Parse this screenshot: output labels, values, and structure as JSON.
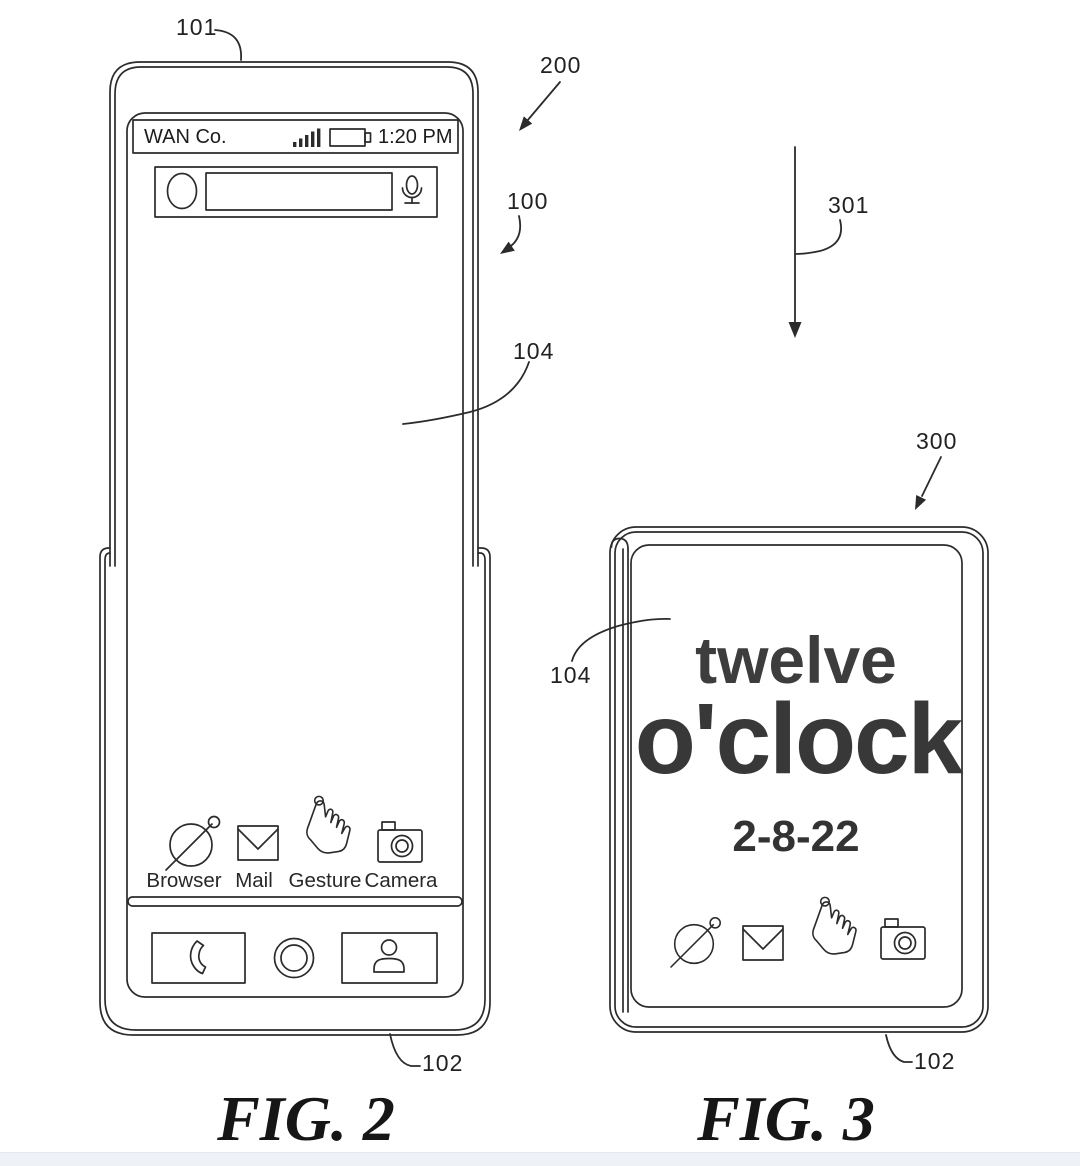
{
  "page": {
    "background": "#ffffff",
    "line_color": "#2b2b2b",
    "footer_strip_color": "#eef1f5"
  },
  "fig2": {
    "caption": "FIG. 2",
    "labels": {
      "l101": "101",
      "l200": "200",
      "l100": "100",
      "l104": "104",
      "l102": "102"
    },
    "status_bar": {
      "carrier": "WAN Co.",
      "time": "1:20 PM",
      "icons": [
        "signal-bars",
        "battery"
      ]
    },
    "search_bar": {
      "value": "",
      "icons": [
        "avatar-circle",
        "microphone"
      ]
    },
    "apps": [
      {
        "label": "Browser",
        "icon": "globe"
      },
      {
        "label": "Mail",
        "icon": "envelope"
      },
      {
        "label": "Gesture",
        "icon": "pointing-hand"
      },
      {
        "label": "Camera",
        "icon": "camera"
      }
    ],
    "nav_buttons": [
      {
        "icon": "phone-handset"
      },
      {
        "icon": "home-circle"
      },
      {
        "icon": "contact-person"
      }
    ]
  },
  "fig3": {
    "caption": "FIG. 3",
    "labels": {
      "l301": "301",
      "l300": "300",
      "l104": "104",
      "l102": "102"
    },
    "clock": {
      "line1": "twelve",
      "line2": "o'clock",
      "date": "2-8-22"
    },
    "apps": [
      {
        "icon": "globe"
      },
      {
        "icon": "envelope"
      },
      {
        "icon": "pointing-hand"
      },
      {
        "icon": "camera"
      }
    ]
  }
}
